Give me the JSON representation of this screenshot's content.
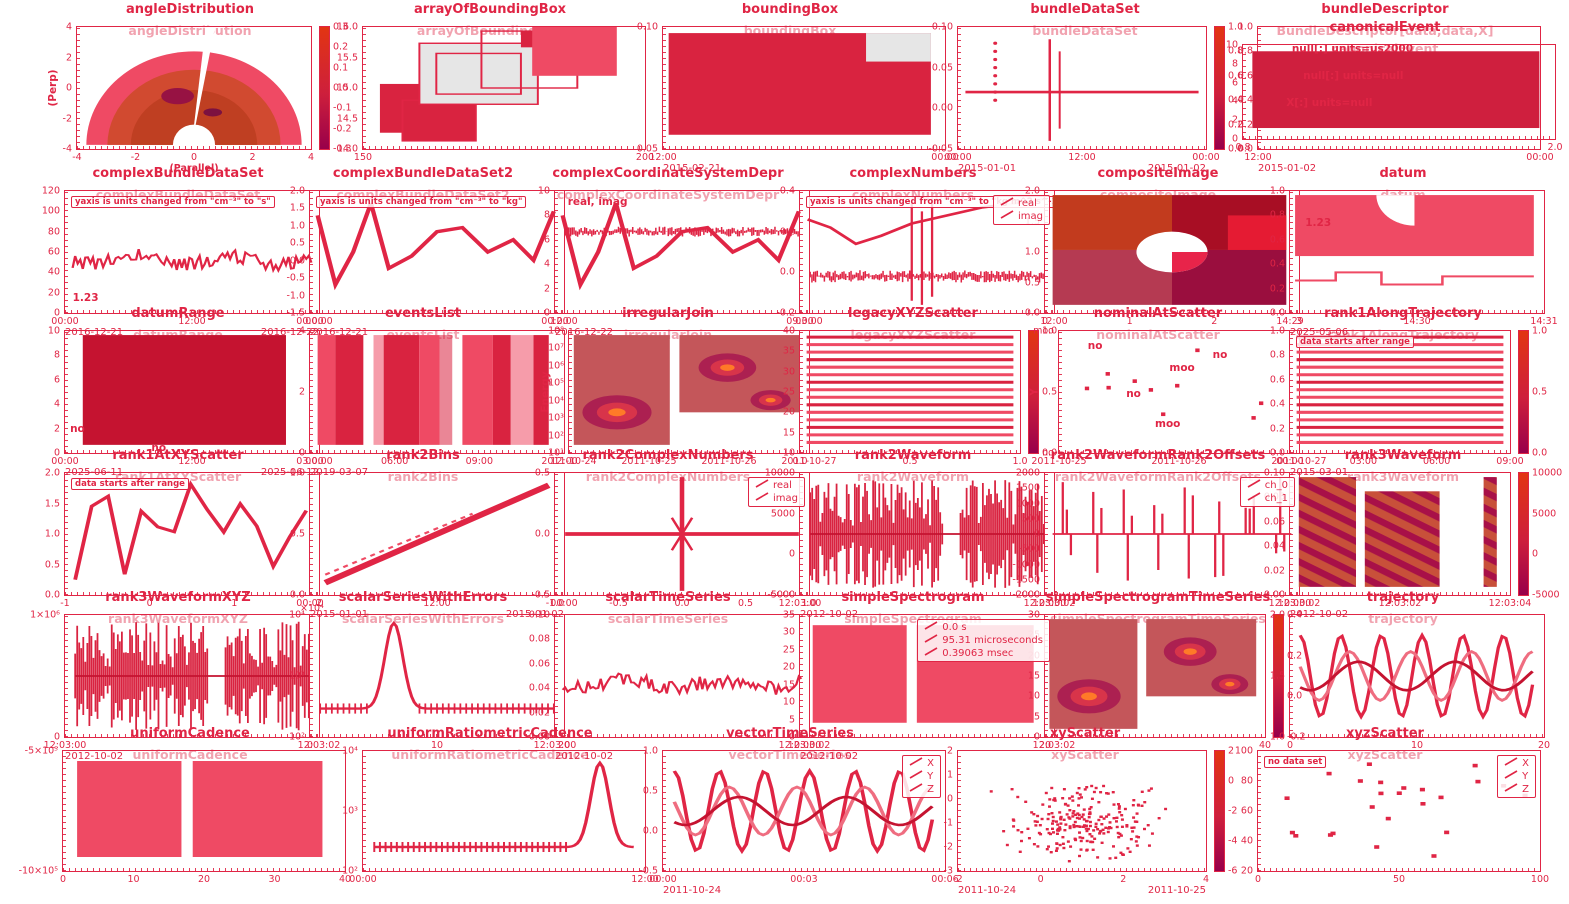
{
  "colors": {
    "accent": "#e02545",
    "light": "#ef4a64",
    "mid": "#d92340",
    "dark": "#c51330",
    "gray": "#e6e6e6",
    "cmap_top": "#e23512",
    "cmap_mid": "#cd1f3c",
    "cmap_bottom": "#98004a",
    "blob_bg": "#c4565a"
  },
  "chart_data": {
    "type": "collage",
    "figure_count": 35,
    "figures": [
      {
        "title": "angleDistribution",
        "axtitle": "angleDistribution",
        "type": "fan",
        "x": 190,
        "y": 2,
        "w": 340,
        "h": 178,
        "ylabel": "(Perp)",
        "xlabel": "(Parallel)",
        "yticks": [
          "4",
          "2",
          "0",
          "-2",
          "-4"
        ],
        "xticks": [
          "-4",
          "-2",
          "0",
          "2",
          "4"
        ],
        "cbar": [
          "0.3",
          "0.2",
          "0.1",
          "0.0",
          "-0.1",
          "-0.2",
          "-0.3"
        ]
      },
      {
        "title": "arrayOfBoundingBox",
        "axtitle": "arrayOfBoundingBox",
        "type": "boxes",
        "x": 490,
        "y": 2,
        "w": 340,
        "h": 178,
        "yticks": [
          "16.0",
          "15.5",
          "15.0",
          "14.5",
          "14.0"
        ],
        "xticks": [
          "150",
          "200"
        ]
      },
      {
        "title": "boundingBox",
        "axtitle": "boundingBox",
        "type": "blockg",
        "x": 790,
        "y": 2,
        "w": 340,
        "h": 178,
        "yticks": [
          "0.10",
          "0.05"
        ],
        "xticks": [
          "12:00",
          "00:00"
        ],
        "dates": [
          "2015-02-21"
        ]
      },
      {
        "title": "bundleDataSet",
        "axtitle": "bundleDataSet",
        "type": "spikeline",
        "x": 1085,
        "y": 2,
        "w": 340,
        "h": 178,
        "yticks": [
          "0.10",
          "0.05",
          "0.00",
          "-0.05"
        ],
        "xticks": [
          "00:00",
          "12:00",
          "00:00"
        ],
        "dates": [
          "2015-01-01",
          "2015-01-02"
        ],
        "cbar": [
          "1.0",
          "0.8",
          "0.6",
          "0.4",
          "0.2",
          "0.0"
        ]
      },
      {
        "title": "bundleDescriptor",
        "axtitle": "BundleDescriptor[data,data,X]",
        "type": "textpanel",
        "x": 1385,
        "y": 2,
        "w": 340,
        "h": 178,
        "yticks": [
          "1.0",
          "0.8",
          "0.6",
          "0.4",
          "0.2",
          "0.0"
        ],
        "xticks": [
          "12:00",
          "00:00"
        ],
        "dates": [
          "2015-01-02"
        ],
        "labels": [
          {
            "t": "null[:] units=us2000",
            "px": 12,
            "py": 18
          },
          {
            "t": "null[:] units=null",
            "px": 16,
            "py": 40
          },
          {
            "t": "X[:] units=null",
            "px": 10,
            "py": 62
          }
        ]
      },
      {
        "title": "canonicalEvent",
        "axtitle": "canonicalEvent",
        "type": "block",
        "x": 1385,
        "y": 20,
        "w": 370,
        "h": 150,
        "yticks": [
          "10",
          "8",
          "6",
          "4",
          "2",
          "0"
        ],
        "xticks": [
          "0.8",
          "2.0"
        ]
      },
      {
        "title": "complexBundleDataSet",
        "axtitle": "complexBundleDataSet",
        "type": "noisy",
        "x": 178,
        "y": 166,
        "w": 312,
        "h": 178,
        "yticks": [
          "120",
          "100",
          "80",
          "60",
          "40",
          "20",
          "0"
        ],
        "xticks": [
          "00:00",
          "12:00",
          "00:00"
        ],
        "dates": [
          "2016-12-21",
          "2016-12-22"
        ],
        "ann": [
          "yaxis is units changed from \"cm⁻³\" to \"s\""
        ],
        "labels": [
          {
            "t": "1.23",
            "px": 3,
            "py": 88
          }
        ]
      },
      {
        "title": "complexBundleDataSet2",
        "axtitle": "complexBundleDataSet2",
        "type": "jagged",
        "x": 423,
        "y": 166,
        "w": 312,
        "h": 178,
        "yticks": [
          "2.0",
          "1.5",
          "1.0",
          "0.5",
          "0.0",
          "-0.5",
          "-1.0",
          "-1.5"
        ],
        "xticks": [
          "00:00",
          "12:00"
        ],
        "dates": [
          "2016-12-21"
        ],
        "ann": [
          "yaxis is units changed from \"cm⁻³\" to \"kg\""
        ]
      },
      {
        "title": "complexCoordinateSystemDepr",
        "axtitle": "complexCoordinateSystemDepr",
        "type": "jagnoise",
        "x": 668,
        "y": 166,
        "w": 312,
        "h": 178,
        "yticks": [
          "10",
          "8",
          "6",
          "4",
          "2",
          "0"
        ],
        "xticks": [
          "00:00",
          "03:00"
        ],
        "dates": [
          "2016-12-22"
        ],
        "labels": [
          {
            "t": "real, imag",
            "px": 5,
            "py": 9
          }
        ]
      },
      {
        "title": "complexNumbers",
        "axtitle": "complexNumbers",
        "type": "spikenoise",
        "x": 913,
        "y": 166,
        "w": 312,
        "h": 178,
        "yticks": [
          "0.4",
          "0.2",
          "0.0",
          "-0.2"
        ],
        "xticks": [
          "09:00",
          "12:00"
        ],
        "legend": [
          "real",
          "imag"
        ],
        "ann": [
          "yaxis is units changed from \"cm⁻³\" to \"kg m^2 s^-1\""
        ]
      },
      {
        "title": "compositeImage",
        "axtitle": "compositeImage",
        "type": "image2x2",
        "x": 1158,
        "y": 166,
        "w": 312,
        "h": 178,
        "yticks": [
          "2.0",
          "1.5",
          "1.0",
          "0.5",
          "0.0"
        ],
        "xticks": [
          "0",
          "1",
          "2",
          "3"
        ]
      },
      {
        "title": "datum",
        "axtitle": "datum",
        "type": "pinkline",
        "x": 1403,
        "y": 166,
        "w": 312,
        "h": 178,
        "yticks": [
          "1.0",
          "0.8",
          "0.6",
          "0.4",
          "0.2",
          "0.0"
        ],
        "xticks": [
          "14:29",
          "14:30",
          "14:31"
        ],
        "dates": [
          "2025-05-06"
        ],
        "labels": [
          {
            "t": "1.23",
            "px": 6,
            "py": 26
          }
        ]
      },
      {
        "title": "datumRange",
        "axtitle": "datumRange",
        "type": "blockdark",
        "x": 178,
        "y": 306,
        "w": 312,
        "h": 178,
        "yticks": [
          "10",
          "8",
          "6",
          "4",
          "2",
          "0"
        ],
        "xticks": [
          "00:00",
          "12:00",
          "00:00"
        ],
        "dates": [
          "2025-06-11",
          "2025-06-12"
        ],
        "labels": [
          {
            "t": "no",
            "px": 2,
            "py": 80
          },
          {
            "t": "no",
            "px": 34,
            "py": 96
          }
        ]
      },
      {
        "title": "eventsList",
        "axtitle": "eventsList",
        "type": "bands",
        "x": 423,
        "y": 306,
        "w": 312,
        "h": 178,
        "yticks": [
          "4",
          "2",
          "0"
        ],
        "xticks": [
          "03:00",
          "06:00",
          "09:00",
          "12:00"
        ],
        "dates": [
          "2019-03-07"
        ]
      },
      {
        "title": "irregularJoin",
        "axtitle": "irregularJoin",
        "type": "blobs",
        "x": 668,
        "y": 306,
        "w": 312,
        "h": 178,
        "ylabel": "Energy",
        "yticks": [
          "10⁸",
          "10⁷",
          "10⁶",
          "10⁵",
          "10⁴",
          "10³",
          "10²",
          "10¹"
        ],
        "xticks": [
          "2011-10-24",
          "2011-10-25",
          "2011-10-26",
          "2011-10-27"
        ]
      },
      {
        "title": "legacyXYZScatter",
        "axtitle": "legacyXYZScatter",
        "type": "stripes",
        "x": 913,
        "y": 306,
        "w": 312,
        "h": 178,
        "yticks": [
          "40",
          "35",
          "30",
          "25",
          "20",
          "15",
          "10"
        ],
        "xticks": [
          "0.0",
          "0.5",
          "1.0"
        ],
        "cbar": [
          "1.0",
          "0.5",
          "0.0"
        ]
      },
      {
        "title": "nominalAtScatter",
        "axtitle": "nominalAtScatter",
        "type": "nscatter",
        "x": 1158,
        "y": 306,
        "w": 312,
        "h": 178,
        "ylabel": "Y",
        "yticks": [
          "moo",
          "no"
        ],
        "xticks": [
          "2011-10-25",
          "2011-10-26",
          "2011-10-27"
        ],
        "labels": [
          {
            "t": "no",
            "px": 12,
            "py": 12
          },
          {
            "t": "moo",
            "px": 46,
            "py": 30
          },
          {
            "t": "no",
            "px": 28,
            "py": 52
          },
          {
            "t": "no",
            "px": 64,
            "py": 20
          },
          {
            "t": "moo",
            "px": 40,
            "py": 76
          }
        ]
      },
      {
        "title": "rank1AlongTrajectory",
        "axtitle": "rank1AlongTrajectory",
        "type": "stripes",
        "x": 1403,
        "y": 306,
        "w": 312,
        "h": 178,
        "yticks": [
          "1.0",
          "0.8",
          "0.6",
          "0.4",
          "0.2",
          "0.0"
        ],
        "xticks": [
          "00:00",
          "03:00",
          "06:00",
          "09:00"
        ],
        "dates": [
          "2015-03-01"
        ],
        "ann": [
          "data starts after range"
        ],
        "cbar": [
          "1.0",
          "0.5",
          "0.0"
        ]
      },
      {
        "title": "rank1AtXYScatter",
        "axtitle": "rank1AtXYScatter",
        "type": "zigzag",
        "x": 178,
        "y": 448,
        "w": 312,
        "h": 178,
        "yticks": [
          "2.0",
          "1.5",
          "1.0",
          "0.5",
          "0.0"
        ],
        "xticks": [
          "-1",
          "0",
          "1",
          "2"
        ],
        "ann": [
          "data starts after range"
        ]
      },
      {
        "title": "rank2Bins",
        "axtitle": "rank2Bins",
        "type": "diag",
        "x": 423,
        "y": 448,
        "w": 312,
        "h": 178,
        "yticks": [
          "1.0",
          "0.5",
          "0.0"
        ],
        "xticks": [
          "00:00",
          "12:00",
          "00:00"
        ],
        "dates": [
          "2015-01-01",
          "2015-01-02"
        ]
      },
      {
        "title": "rank2ComplexNumbers",
        "axtitle": "rank2ComplexNumbers",
        "type": "cross",
        "x": 668,
        "y": 448,
        "w": 312,
        "h": 178,
        "yticks": [
          "0.5",
          "0.0",
          "-0.5"
        ],
        "xticks": [
          "-1.0",
          "-0.5",
          "0.0",
          "0.5",
          "1.0"
        ],
        "legend": [
          "real",
          "imag"
        ]
      },
      {
        "title": "rank2Waveform",
        "axtitle": "rank2Waveform",
        "type": "wave",
        "x": 913,
        "y": 448,
        "w": 312,
        "h": 178,
        "yticks": [
          "10000",
          "5000",
          "0",
          "-5000"
        ],
        "xticks": [
          "12:03:00",
          "12:03:02"
        ],
        "dates": [
          "2012-10-02"
        ]
      },
      {
        "title": "rank2WaveformRank2Offsets",
        "axtitle": "rank2WaveformRank2Offsets",
        "type": "spikesets",
        "x": 1158,
        "y": 448,
        "w": 312,
        "h": 178,
        "yticks": [
          "2000",
          "1500",
          "1000",
          "500",
          "0",
          "-500",
          "-1000",
          "-1500",
          "-2000"
        ],
        "xticks": [
          "12:03:00",
          "12:03:02"
        ],
        "legend": [
          "ch_0",
          "ch_1"
        ]
      },
      {
        "title": "rank3Waveform",
        "axtitle": "rank3Waveform",
        "type": "stripblocks",
        "x": 1403,
        "y": 448,
        "w": 312,
        "h": 178,
        "yticks": [
          "0.10",
          "0.08",
          "0.06",
          "0.04",
          "0.02",
          "0.00"
        ],
        "xticks": [
          "12:03:00",
          "12:03:02",
          "12:03:04"
        ],
        "dates": [
          "2012-10-02"
        ],
        "cbar": [
          "10000",
          "5000",
          "0",
          "-5000"
        ]
      },
      {
        "title": "rank3WaveformXYZ",
        "axtitle": "rank3WaveformXYZ",
        "type": "wave",
        "x": 178,
        "y": 590,
        "w": 312,
        "h": 178,
        "yticks": [
          "1×10⁶",
          "0"
        ],
        "xticks": [
          "12:03:00",
          "12:03:02"
        ],
        "dates": [
          "2012-10-02"
        ]
      },
      {
        "title": "scalarSeriesWithErrors",
        "axtitle": "scalarSeriesWithErrors",
        "type": "peak",
        "x": 423,
        "y": 590,
        "w": 312,
        "h": 178,
        "yticks": [
          "10⁴",
          "10³",
          "10²"
        ],
        "xticks": [
          "0",
          "10",
          "20"
        ],
        "note": "×10⁴"
      },
      {
        "title": "scalarTimeSeries",
        "axtitle": "scalarTimeSeries",
        "type": "noisy",
        "x": 668,
        "y": 590,
        "w": 312,
        "h": 178,
        "yticks": [
          "0.10",
          "0.08",
          "0.06",
          "0.04",
          "0.02",
          "0.00"
        ],
        "xticks": [
          "12:03:00",
          "12:03:02"
        ],
        "dates": [
          "2012-10-02"
        ]
      },
      {
        "title": "simpleSpectrogram",
        "axtitle": "simpleSpectrogram",
        "type": "blockgap",
        "x": 913,
        "y": 590,
        "w": 312,
        "h": 178,
        "yticks": [
          "35",
          "30",
          "25",
          "20",
          "15",
          "10",
          "5",
          "0"
        ],
        "xticks": [
          "12:03:00",
          "12:03:02"
        ],
        "dates": [
          "2012-10-02"
        ],
        "legend": [
          "0.0 s",
          "95.31 microseconds",
          "0.39063 msec"
        ]
      },
      {
        "title": "simpleSpectrogramTimeSeries",
        "axtitle": "simpleSpectrogramTimeSeries",
        "type": "blobs",
        "x": 1158,
        "y": 590,
        "w": 312,
        "h": 178,
        "yticks": [
          "30",
          "25",
          "20",
          "15",
          "10",
          "5",
          "0"
        ],
        "xticks": [
          "20",
          "40"
        ],
        "cbar": [
          "0.4",
          "0.2",
          "0.0",
          "-0.2"
        ]
      },
      {
        "title": "trajectory",
        "axtitle": "trajectory",
        "type": "sines",
        "x": 1403,
        "y": 590,
        "w": 312,
        "h": 178,
        "yticks": [
          "2.0",
          "1.5",
          "1.0"
        ],
        "xticks": [
          "0",
          "10",
          "20"
        ]
      },
      {
        "title": "uniformCadence",
        "axtitle": "uniformCadence",
        "type": "blockgap",
        "x": 190,
        "y": 726,
        "w": 340,
        "h": 176,
        "yticks": [
          "-5×10⁵",
          "-10×10⁵"
        ],
        "xticks": [
          "0",
          "10",
          "20",
          "30",
          "40"
        ]
      },
      {
        "title": "uniformRatiometricCadence",
        "axtitle": "uniformRatiometricCadence",
        "type": "peak2",
        "x": 490,
        "y": 726,
        "w": 340,
        "h": 176,
        "yticks": [
          "10⁴",
          "10³",
          "10²"
        ],
        "xticks": [
          "00:00",
          "12:00"
        ]
      },
      {
        "title": "vectorTimeSeries",
        "axtitle": "vectorTimeSeries",
        "type": "sines",
        "x": 790,
        "y": 726,
        "w": 340,
        "h": 176,
        "yticks": [
          "1.0",
          "0.5",
          "0.0",
          "-0.5"
        ],
        "xticks": [
          "00:00",
          "00:03",
          "00:06"
        ],
        "dates": [
          "2011-10-24"
        ],
        "legend": [
          "X",
          "Y",
          "Z"
        ]
      },
      {
        "title": "xyScatter",
        "axtitle": "xyScatter",
        "type": "scatter",
        "x": 1085,
        "y": 726,
        "w": 340,
        "h": 176,
        "yticks": [
          "2",
          "1",
          "0",
          "-1",
          "-2",
          "-3"
        ],
        "xticks": [
          "-2",
          "0",
          "2",
          "4"
        ],
        "dates": [
          "2011-10-24",
          "2011-10-25"
        ],
        "cbar": [
          "2",
          "0",
          "-2",
          "-4",
          "-6"
        ]
      },
      {
        "title": "xyzScatter",
        "axtitle": "xyzScatter",
        "type": "sscatter",
        "x": 1385,
        "y": 726,
        "w": 340,
        "h": 176,
        "yticks": [
          "100",
          "80",
          "60",
          "40",
          "20"
        ],
        "xticks": [
          "0",
          "50",
          "100"
        ],
        "legend": [
          "X",
          "Y",
          "Z"
        ],
        "ann": [
          "no data set"
        ]
      }
    ]
  }
}
